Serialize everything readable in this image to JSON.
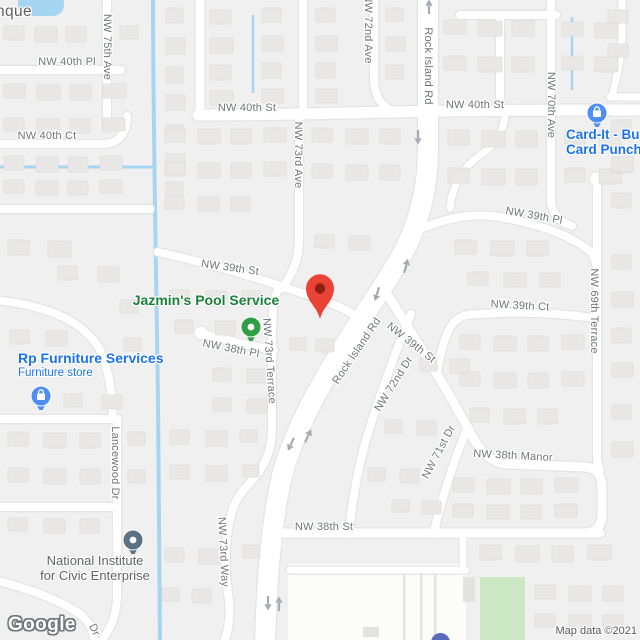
{
  "map": {
    "attribution": "Map data ©2021",
    "watermark": "Google",
    "locality_partial_label": "nque",
    "colors": {
      "background": "#f0f0f0",
      "road_fill": "#ffffff",
      "road_casing": "#e4e4e3",
      "building": "#e9e8e6",
      "building_stroke": "#dcdcda",
      "water": "#a6d5f2",
      "park": "#cbe7c4",
      "lot_white": "#fcfcfb",
      "lot_strip": "#e2e2e1",
      "street_label_gray": "#70757a",
      "locality_gray": "#5d5d5d",
      "poi_blue": "#1a73e8",
      "poi_green": "#188038",
      "poi_gray": "#5f6368",
      "pin_blue": "#4f8ef5",
      "pin_green": "#2f9e44",
      "pin_gray": "#5b7282",
      "marker_red": "#ea4335",
      "marker_red_dark": "#8f1d13",
      "arrow_gray": "#a4aab1",
      "school_purple": "#5b6abf"
    },
    "street_labels": [
      {
        "text": "NW 40th Pl",
        "x": 67,
        "y": 62,
        "rot": 0
      },
      {
        "text": "NW 75th Ave",
        "x": 107,
        "y": 47,
        "rot": 90
      },
      {
        "text": "NW 40th St",
        "x": 247,
        "y": 108,
        "rot": 0
      },
      {
        "text": "NW 40th Ct",
        "x": 47,
        "y": 136,
        "rot": 0
      },
      {
        "text": "NW 73rd Ave",
        "x": 298,
        "y": 155,
        "rot": 90
      },
      {
        "text": "NW 72nd Ave",
        "x": 368,
        "y": 29,
        "rot": 90
      },
      {
        "text": "Rock Island Rd",
        "x": 428,
        "y": 66,
        "rot": 90
      },
      {
        "text": "NW 40th St",
        "x": 475,
        "y": 105,
        "rot": 0
      },
      {
        "text": "NW 70th Ave",
        "x": 551,
        "y": 105,
        "rot": 90
      },
      {
        "text": "NW 39th Pl",
        "x": 534,
        "y": 216,
        "rot": 10
      },
      {
        "text": "NW 39th St",
        "x": 230,
        "y": 268,
        "rot": 8
      },
      {
        "text": "NW 39th Ct",
        "x": 520,
        "y": 306,
        "rot": 3
      },
      {
        "text": "NW 69th Terrace",
        "x": 594,
        "y": 311,
        "rot": 90
      },
      {
        "text": "Rock Island Rd",
        "x": 357,
        "y": 351,
        "rot": -56
      },
      {
        "text": "NW 39th St",
        "x": 411,
        "y": 343,
        "rot": 38
      },
      {
        "text": "NW 38th Pl",
        "x": 231,
        "y": 349,
        "rot": 11
      },
      {
        "text": "NW 73rd Terrace",
        "x": 269,
        "y": 361,
        "rot": 86
      },
      {
        "text": "NW 72nd Dr",
        "x": 394,
        "y": 384,
        "rot": -58
      },
      {
        "text": "NW 71st Dr",
        "x": 439,
        "y": 452,
        "rot": -62
      },
      {
        "text": "NW 38th Manor",
        "x": 513,
        "y": 456,
        "rot": 3
      },
      {
        "text": "NW 38th St",
        "x": 324,
        "y": 527,
        "rot": 0
      },
      {
        "text": "NW 73rd Way",
        "x": 223,
        "y": 552,
        "rot": 87
      },
      {
        "text": "Lancewood Dr",
        "x": 115,
        "y": 463,
        "rot": 90
      },
      {
        "text": "Dr",
        "x": 94,
        "y": 630,
        "rot": 65
      }
    ],
    "pois": [
      {
        "id": "jazmins-pool-service",
        "title_lines": [
          "Jazmin's Pool Service"
        ],
        "subtitle": null,
        "color_key": "poi_green",
        "align": "center",
        "tx": 206,
        "ty": 293,
        "size": 14,
        "pin": {
          "type": "dot",
          "color_key": "pin_green",
          "x": 251,
          "y": 321
        }
      },
      {
        "id": "rp-furniture-services",
        "title_lines": [
          "Rp Furniture Services"
        ],
        "subtitle": "Furniture store",
        "color_key": "poi_blue",
        "align": "left",
        "tx": 18,
        "ty": 351,
        "size": 14,
        "pin": {
          "type": "shopping",
          "color_key": "pin_blue",
          "x": 41,
          "y": 390
        }
      },
      {
        "id": "card-it-card-punch",
        "title_lines": [
          "Card-It - Bu",
          "Card Punch"
        ],
        "subtitle": null,
        "color_key": "poi_blue",
        "align": "left",
        "tx": 566,
        "ty": 128,
        "size": 13.5,
        "pin": {
          "type": "shopping",
          "color_key": "pin_blue",
          "x": 597,
          "y": 107
        }
      },
      {
        "id": "national-institute-for-civic-enterprise",
        "title_lines": [
          "National Institute",
          "for Civic Enterprise"
        ],
        "subtitle": null,
        "color_key": "poi_gray",
        "align": "center",
        "tx": 95,
        "ty": 554,
        "size": 13,
        "weight": "normal",
        "pin": {
          "type": "dot",
          "color_key": "pin_gray",
          "x": 133,
          "y": 534
        }
      }
    ],
    "marker": {
      "name": "red-map-pin",
      "x": 320,
      "y": 319
    },
    "school_dot": {
      "x": 440,
      "y": 644
    },
    "arrows": [
      {
        "x": 429,
        "y": 7,
        "rot": 0
      },
      {
        "x": 418,
        "y": 137,
        "rot": 180
      },
      {
        "x": 406,
        "y": 266,
        "rot": 15
      },
      {
        "x": 377,
        "y": 294,
        "rot": 197
      },
      {
        "x": 308,
        "y": 436,
        "rot": 25
      },
      {
        "x": 291,
        "y": 444,
        "rot": 205
      },
      {
        "x": 268,
        "y": 603,
        "rot": 180
      },
      {
        "x": 279,
        "y": 604,
        "rot": 0
      }
    ]
  }
}
